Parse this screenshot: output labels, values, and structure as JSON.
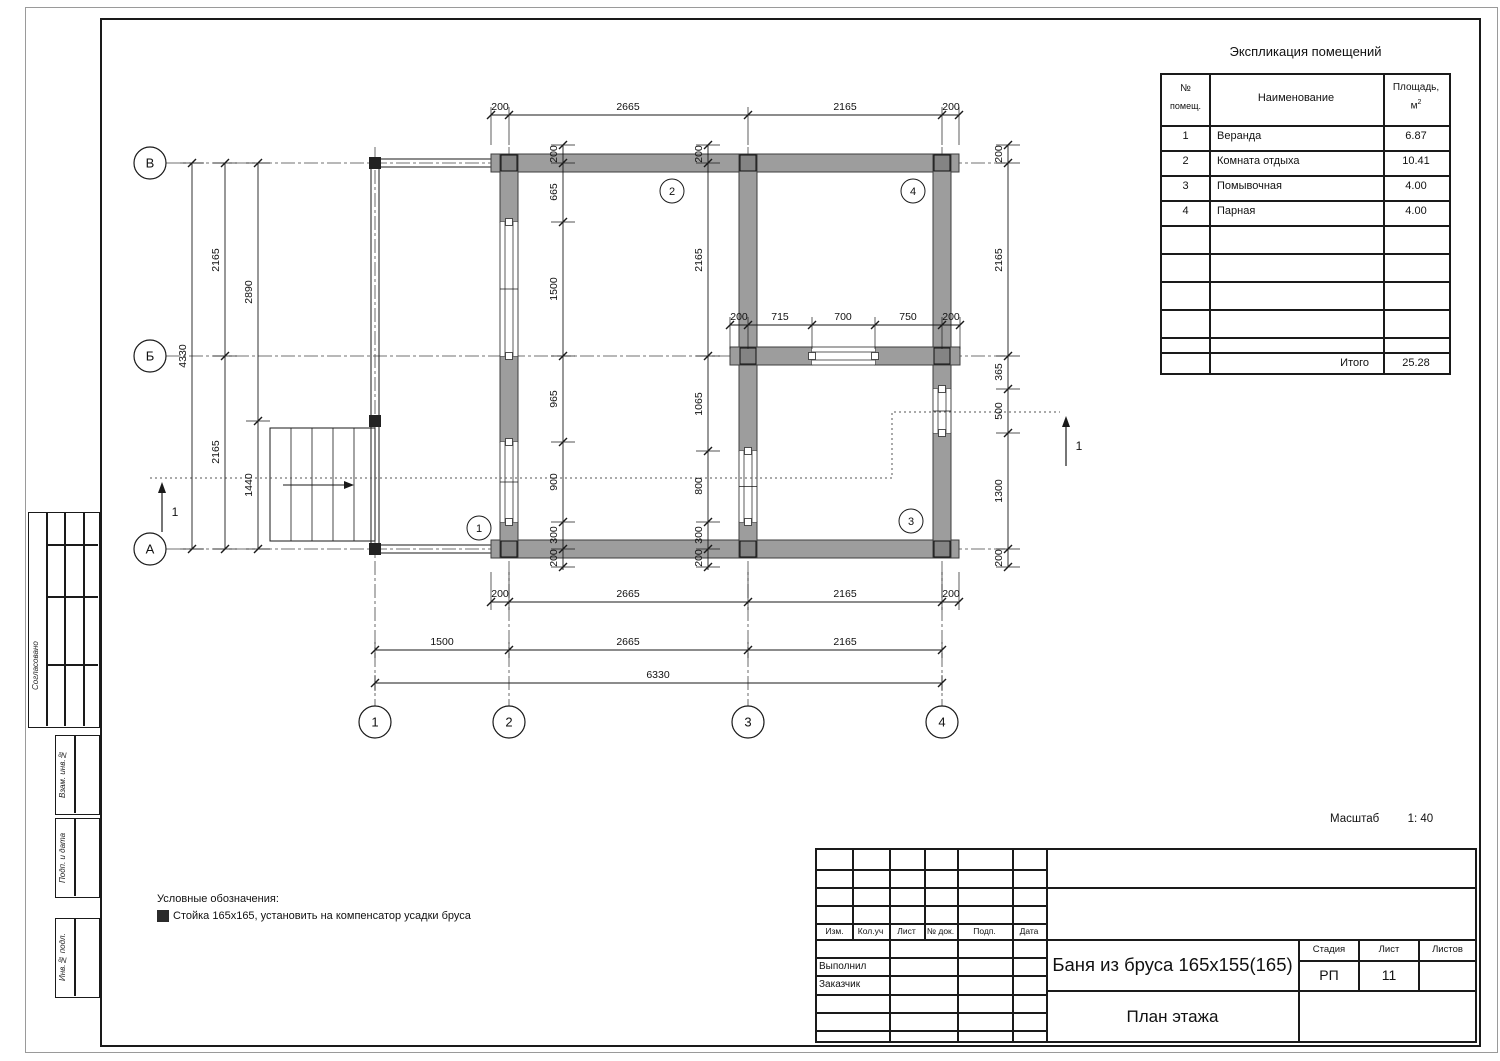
{
  "legend": {
    "title": "Условные обозначения:",
    "item": "Стойка 165х165, установить на компенсатор усадки бруса",
    "swatch_color": "#2b2b2b"
  },
  "scale_note": {
    "label": "Масштаб",
    "value": "1: 40"
  },
  "side_stamp": {
    "approved_label": "Согласовано",
    "blocks": [
      {
        "label": "Взам. инв.№"
      },
      {
        "label": "Подп. и дата"
      },
      {
        "label": "Инв.№ подл."
      }
    ]
  },
  "room_table": {
    "title": "Экспликация помещений",
    "header": {
      "num1": "№",
      "num2": "помещ.",
      "name": "Наименование",
      "area1": "Площадь,",
      "area2": "м",
      "area_sup": "2"
    },
    "rows": [
      {
        "n": "1",
        "name": "Веранда",
        "area": "6.87"
      },
      {
        "n": "2",
        "name": "Комната отдыха",
        "area": "10.41"
      },
      {
        "n": "3",
        "name": "Помывочная",
        "area": "4.00"
      },
      {
        "n": "4",
        "name": "Парная",
        "area": "4.00"
      }
    ],
    "empty_rows": 5,
    "total_label": "Итого",
    "total_value": "25.28"
  },
  "title_block": {
    "col_headers": [
      "Изм.",
      "Кол.уч",
      "Лист",
      "№ док.",
      "Подп.",
      "Дата"
    ],
    "row_labels": [
      "Выполнил",
      "Заказчик"
    ],
    "doc_title": "Баня из бруса 165х155(165)",
    "stage_label": "Стадия",
    "stage_value": "РП",
    "sheet_label": "Лист",
    "sheet_value": "11",
    "sheets_label": "Листов",
    "sheets_value": "",
    "drawing_name": "План этажа"
  },
  "plan": {
    "colors": {
      "wall_fill": "#9d9d9d",
      "wall_stroke": "#3d3d3d",
      "line": "#1a1a1a",
      "column_fill": "#848484",
      "post_fill": "#222222",
      "dim_text": "#111111",
      "axis_line": "#444444",
      "section_line": "#555555"
    },
    "axes_h": [
      {
        "label": "В",
        "y": 163
      },
      {
        "label": "Б",
        "y": 356
      },
      {
        "label": "А",
        "y": 549
      }
    ],
    "axes_v": [
      {
        "label": "1",
        "x": 375
      },
      {
        "label": "2",
        "x": 509
      },
      {
        "label": "3",
        "x": 748
      },
      {
        "label": "4",
        "x": 942
      }
    ],
    "axis_line_x": [
      166,
      1005
    ],
    "axis_line_y": [
      147,
      706
    ],
    "bubble_left_x": 150,
    "bubble_bottom_y": 722,
    "bubble_r": 16,
    "walls": [
      [
        491,
        154,
        468,
        18
      ],
      [
        491,
        540,
        468,
        18
      ],
      [
        500,
        154,
        18,
        68
      ],
      [
        500,
        356,
        18,
        86
      ],
      [
        500,
        522,
        18,
        36
      ],
      [
        739,
        154,
        18,
        297
      ],
      [
        739,
        522,
        18,
        36
      ],
      [
        933,
        154,
        18,
        235
      ],
      [
        933,
        433,
        18,
        125
      ],
      [
        730,
        347,
        82,
        18
      ],
      [
        875,
        347,
        85,
        18
      ]
    ],
    "openings": [
      {
        "x": 500,
        "y": 222,
        "w": 18,
        "h": 134,
        "dir": "v"
      },
      {
        "x": 500,
        "y": 442,
        "w": 18,
        "h": 80,
        "dir": "v"
      },
      {
        "x": 739,
        "y": 451,
        "w": 18,
        "h": 71,
        "dir": "v"
      },
      {
        "x": 933,
        "y": 389,
        "w": 18,
        "h": 44,
        "dir": "v"
      },
      {
        "x": 812,
        "y": 347,
        "w": 63,
        "h": 18,
        "dir": "h"
      }
    ],
    "columns": [
      [
        509,
        163
      ],
      [
        748,
        163
      ],
      [
        942,
        163
      ],
      [
        509,
        549
      ],
      [
        748,
        549
      ],
      [
        942,
        549
      ],
      [
        748,
        356
      ],
      [
        942,
        356
      ]
    ],
    "col_size": 16,
    "posts": [
      [
        375,
        163
      ],
      [
        375,
        421
      ],
      [
        375,
        549
      ]
    ],
    "post_size": 12,
    "veranda_lines": [
      [
        381,
        159,
        500,
        159
      ],
      [
        381,
        167,
        500,
        167
      ],
      [
        381,
        545,
        500,
        545
      ],
      [
        381,
        553,
        500,
        553
      ],
      [
        371,
        169,
        371,
        543
      ],
      [
        379,
        169,
        379,
        543
      ]
    ],
    "stairs": {
      "x": 270,
      "y": 428,
      "w": 105,
      "h": 113,
      "risers": [
        291,
        312,
        333,
        354
      ],
      "arrow_y": 485,
      "arrow_x1": 283,
      "arrow_x2": 352
    },
    "section": {
      "label": "1",
      "path": [
        [
          150,
          478
        ],
        [
          892,
          478
        ],
        [
          892,
          412
        ],
        [
          1060,
          412
        ]
      ],
      "arrows": [
        {
          "x": 162,
          "y1": 532,
          "y2": 484,
          "lx": 175,
          "ly": 516
        },
        {
          "x": 1066,
          "y1": 466,
          "y2": 418,
          "lx": 1079,
          "ly": 450
        }
      ]
    },
    "rooms": [
      {
        "n": "1",
        "x": 479,
        "y": 528
      },
      {
        "n": "2",
        "x": 672,
        "y": 191
      },
      {
        "n": "3",
        "x": 911,
        "y": 521
      },
      {
        "n": "4",
        "x": 913,
        "y": 191
      }
    ],
    "room_r": 12,
    "dims_h": [
      {
        "y": 115,
        "x1": 491,
        "x2": 959,
        "g": [
          -8,
          30
        ],
        "ticks": [
          491,
          509,
          748,
          942,
          959
        ],
        "labels": [
          [
            "200",
            500
          ],
          [
            "2665",
            628
          ],
          [
            "2165",
            845
          ],
          [
            "200",
            951
          ]
        ]
      },
      {
        "y": 602,
        "x1": 491,
        "x2": 959,
        "g": [
          -30,
          8
        ],
        "ticks": [
          491,
          509,
          748,
          942,
          959
        ],
        "labels": [
          [
            "200",
            500
          ],
          [
            "2665",
            628
          ],
          [
            "2165",
            845
          ],
          [
            "200",
            951
          ]
        ]
      },
      {
        "y": 650,
        "x1": 375,
        "x2": 942,
        "g": [
          -8,
          8
        ],
        "ticks": [
          375,
          509,
          748,
          942
        ],
        "labels": [
          [
            "1500",
            442
          ],
          [
            "2665",
            628
          ],
          [
            "2165",
            845
          ]
        ]
      },
      {
        "y": 683,
        "x1": 375,
        "x2": 942,
        "g": [
          -8,
          8
        ],
        "ticks": [
          375,
          942
        ],
        "labels": [
          [
            "6330",
            658
          ]
        ]
      },
      {
        "y": 325,
        "x1": 730,
        "x2": 960,
        "g": [
          -8,
          24
        ],
        "ticks": [
          730,
          748,
          812,
          875,
          942,
          960
        ],
        "labels": [
          [
            "200",
            739
          ],
          [
            "715",
            780
          ],
          [
            "700",
            843
          ],
          [
            "750",
            908
          ],
          [
            "200",
            951
          ]
        ]
      }
    ],
    "dims_v": [
      {
        "x": 192,
        "y1": 163,
        "y2": 549,
        "ticks": [
          163,
          549
        ],
        "labels": [
          [
            "4330",
            356
          ]
        ]
      },
      {
        "x": 225,
        "y1": 163,
        "y2": 549,
        "ticks": [
          163,
          356,
          549
        ],
        "labels": [
          [
            "2165",
            260
          ],
          [
            "2165",
            452
          ]
        ]
      },
      {
        "x": 258,
        "y1": 163,
        "y2": 549,
        "ticks": [
          163,
          421,
          549
        ],
        "labels": [
          [
            "2890",
            292
          ],
          [
            "1440",
            485
          ]
        ]
      },
      {
        "x": 1008,
        "y1": 145,
        "y2": 567,
        "ticks": [
          145,
          163,
          356,
          389,
          433,
          549,
          567
        ],
        "labels": [
          [
            "200",
            154
          ],
          [
            "2165",
            260
          ],
          [
            "365",
            372
          ],
          [
            "500",
            411
          ],
          [
            "1300",
            491
          ],
          [
            "200",
            558
          ]
        ]
      },
      {
        "x": 563,
        "y1": 145,
        "y2": 570,
        "ticks": [
          145,
          163,
          222,
          356,
          442,
          522,
          549,
          567
        ],
        "labels": [
          [
            "200",
            154
          ],
          [
            "665",
            192
          ],
          [
            "1500",
            289
          ],
          [
            "965",
            399
          ],
          [
            "900",
            482
          ],
          [
            "300",
            535
          ],
          [
            "200",
            558
          ]
        ]
      },
      {
        "x": 708,
        "y1": 145,
        "y2": 570,
        "ticks": [
          145,
          163,
          356,
          451,
          522,
          549,
          567
        ],
        "labels": [
          [
            "200",
            154
          ],
          [
            "2165",
            260
          ],
          [
            "1065",
            404
          ],
          [
            "800",
            486
          ],
          [
            "300",
            535
          ],
          [
            "200",
            558
          ]
        ]
      }
    ]
  }
}
